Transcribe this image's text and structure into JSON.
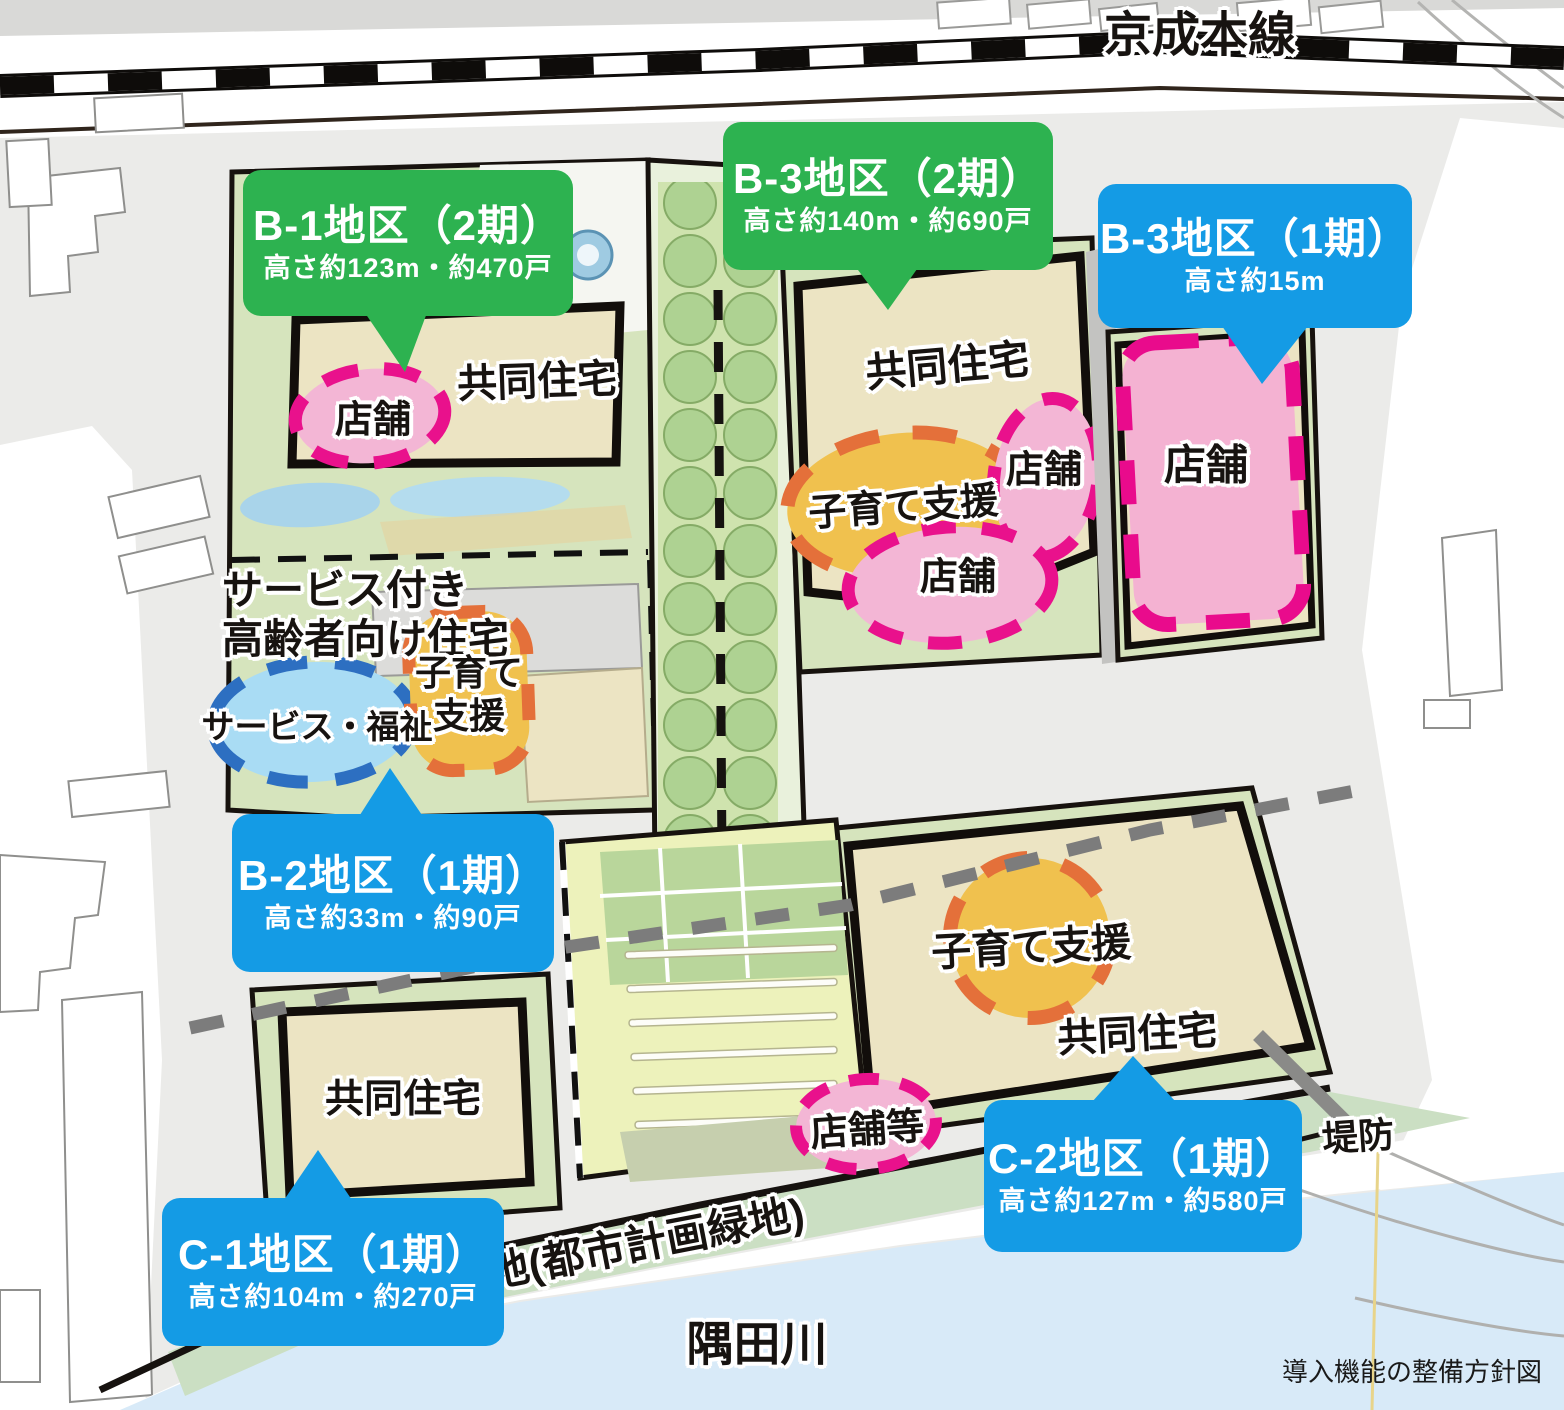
{
  "caption": "導入機能の整備方針図",
  "map_labels": {
    "railway": "京成本線",
    "river": "隅田川",
    "greenbelt": "地(都市計画緑地)",
    "embankment": "堤防"
  },
  "districts": {
    "b1": {
      "title": "B-1地区（2期）",
      "subtitle": "高さ約123m・約470戸",
      "housing": "共同住宅",
      "shop": "店舗"
    },
    "b3_p2": {
      "title": "B-3地区（2期）",
      "subtitle": "高さ約140m・約690戸",
      "housing": "共同住宅",
      "childcare": "子育て支援",
      "shop_upper": "店舗",
      "shop_lower": "店舗"
    },
    "b3_p1": {
      "title": "B-3地区（1期）",
      "subtitle": "高さ約15m",
      "shop": "店舗"
    },
    "b2": {
      "title": "B-2地区（1期）",
      "subtitle": "高さ約33m・約90戸",
      "senior_housing_line1": "サービス付き",
      "senior_housing_line2": "高齢者向け住宅",
      "service_welfare": "サービス・福祉",
      "childcare_line1": "子育て",
      "childcare_line2": "支援"
    },
    "c1": {
      "title": "C-1地区（1期）",
      "subtitle": "高さ約104m・約270戸",
      "housing": "共同住宅"
    },
    "c2": {
      "title": "C-2地区（1期）",
      "subtitle": "高さ約127m・約580戸",
      "childcare": "子育て支援",
      "housing": "共同住宅",
      "shop_etc": "店舗等"
    }
  },
  "colors": {
    "callout_green": "#2db250",
    "callout_blue": "#149be5",
    "building_beige": "#ece4c3",
    "shop_pink_fill": "#f3b6d5",
    "shop_pink_dash": "#e9118c",
    "childcare_orange_fill": "#f0c14e",
    "childcare_orange_dash": "#e4703a",
    "welfare_blue_fill": "#a9dcf4",
    "welfare_blue_dash": "#2d6fc1",
    "park_green": "#d6e4bd",
    "road_gray": "#ebebe9",
    "water_blue": "#d8eaf8",
    "phase_line_gray": "#7c7c7c"
  }
}
